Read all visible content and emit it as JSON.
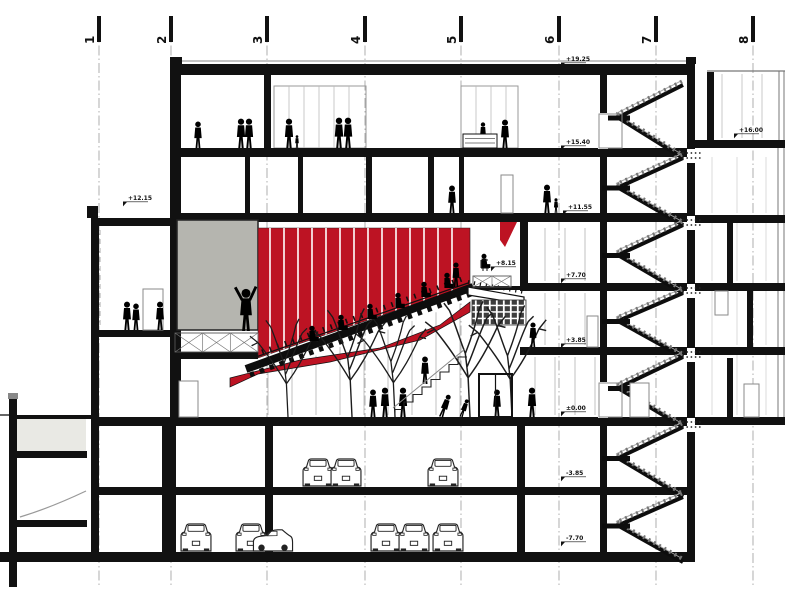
{
  "colors": {
    "red": "#bd1323",
    "gray_box": "#b5b5af",
    "ink": "#111111",
    "silhouette": "#000000",
    "muted": "#999999",
    "light_fill": "#e9e9e4",
    "checker_dark": "#3d3d3d"
  },
  "grid": {
    "axes": [
      {
        "label": "1",
        "x": 99
      },
      {
        "label": "2",
        "x": 171
      },
      {
        "label": "3",
        "x": 267
      },
      {
        "label": "4",
        "x": 365
      },
      {
        "label": "5",
        "x": 461
      },
      {
        "label": "6",
        "x": 559
      },
      {
        "label": "7",
        "x": 656
      },
      {
        "label": "8",
        "x": 753
      }
    ]
  },
  "elevations": [
    {
      "label": "+19.25",
      "x": 565,
      "y": 61
    },
    {
      "label": "+16.00",
      "x": 738,
      "y": 132
    },
    {
      "label": "+15.40",
      "x": 565,
      "y": 144
    },
    {
      "label": "+12.15",
      "x": 127,
      "y": 200
    },
    {
      "label": "+11.55",
      "x": 567,
      "y": 209
    },
    {
      "label": "+8.15",
      "x": 495,
      "y": 265
    },
    {
      "label": "+7.70",
      "x": 565,
      "y": 277
    },
    {
      "label": "+3.85",
      "x": 565,
      "y": 342
    },
    {
      "label": "±0.00",
      "x": 565,
      "y": 410
    },
    {
      "label": "-3.85",
      "x": 565,
      "y": 475
    },
    {
      "label": "-7.70",
      "x": 565,
      "y": 540
    }
  ],
  "auditorium": {
    "fin_start": 270,
    "fin_end": 461,
    "fin_step": 14
  },
  "stairs": {
    "levels": [
      75,
      148,
      215,
      283,
      347,
      417,
      487,
      552
    ],
    "left_x": 616,
    "right_x": 681,
    "landing_x": 602
  },
  "people": [
    {
      "x": 198,
      "y": 148,
      "h": 27,
      "t": "stand"
    },
    {
      "x": 241,
      "y": 148,
      "h": 30,
      "t": "stand"
    },
    {
      "x": 249,
      "y": 148,
      "h": 30,
      "t": "stand"
    },
    {
      "x": 289,
      "y": 148,
      "h": 30,
      "t": "stand"
    },
    {
      "x": 297,
      "y": 148,
      "h": 13,
      "t": "child"
    },
    {
      "x": 339,
      "y": 148,
      "h": 31,
      "t": "stand"
    },
    {
      "x": 348,
      "y": 148,
      "h": 31,
      "t": "stand"
    },
    {
      "x": 483,
      "y": 143,
      "h": 21,
      "t": "stand"
    },
    {
      "x": 505,
      "y": 148,
      "h": 29,
      "t": "stand"
    },
    {
      "x": 452,
      "y": 213,
      "h": 28,
      "t": "stand"
    },
    {
      "x": 547,
      "y": 213,
      "h": 29,
      "t": "stand"
    },
    {
      "x": 556,
      "y": 213,
      "h": 15,
      "t": "child"
    },
    {
      "x": 127,
      "y": 330,
      "h": 29,
      "t": "stand"
    },
    {
      "x": 136,
      "y": 330,
      "h": 27,
      "t": "stand"
    },
    {
      "x": 160,
      "y": 330,
      "h": 29,
      "t": "stand"
    },
    {
      "x": 246,
      "y": 331,
      "h": 43,
      "t": "armup"
    },
    {
      "x": 312,
      "y": 341,
      "h": 15,
      "t": "seated"
    },
    {
      "x": 341,
      "y": 330,
      "h": 15,
      "t": "seated"
    },
    {
      "x": 370,
      "y": 319,
      "h": 15,
      "t": "seated"
    },
    {
      "x": 398,
      "y": 308,
      "h": 15,
      "t": "seated"
    },
    {
      "x": 424,
      "y": 297,
      "h": 15,
      "t": "seated"
    },
    {
      "x": 447,
      "y": 288,
      "h": 15,
      "t": "seated"
    },
    {
      "x": 456,
      "y": 287,
      "h": 25,
      "t": "stand"
    },
    {
      "x": 484,
      "y": 268,
      "h": 14,
      "t": "seated"
    },
    {
      "x": 373,
      "y": 417,
      "h": 28,
      "t": "stand"
    },
    {
      "x": 385,
      "y": 417,
      "h": 30,
      "t": "stand"
    },
    {
      "x": 403,
      "y": 417,
      "h": 30,
      "t": "stand"
    },
    {
      "x": 425,
      "y": 384,
      "h": 28,
      "t": "stand"
    },
    {
      "x": 441,
      "y": 417,
      "h": 24,
      "t": "bend"
    },
    {
      "x": 461,
      "y": 417,
      "h": 19,
      "t": "bend"
    },
    {
      "x": 497,
      "y": 417,
      "h": 28,
      "t": "stand"
    },
    {
      "x": 532,
      "y": 417,
      "h": 30,
      "t": "stand"
    },
    {
      "x": 533,
      "y": 347,
      "h": 25,
      "t": "stand"
    }
  ],
  "cars": [
    {
      "x": 318,
      "y": 486,
      "t": "rear"
    },
    {
      "x": 346,
      "y": 486,
      "t": "rear"
    },
    {
      "x": 443,
      "y": 486,
      "t": "rear"
    },
    {
      "x": 196,
      "y": 551,
      "t": "rear"
    },
    {
      "x": 251,
      "y": 551,
      "t": "rear"
    },
    {
      "x": 273,
      "y": 551,
      "t": "side"
    },
    {
      "x": 386,
      "y": 551,
      "t": "rear"
    },
    {
      "x": 414,
      "y": 551,
      "t": "rear"
    },
    {
      "x": 448,
      "y": 551,
      "t": "rear"
    }
  ],
  "trees": [
    {
      "x": 288,
      "y": 417,
      "h": 95
    },
    {
      "x": 352,
      "y": 417,
      "h": 105
    },
    {
      "x": 395,
      "y": 417,
      "h": 98
    },
    {
      "x": 470,
      "y": 417,
      "h": 112
    },
    {
      "x": 512,
      "y": 417,
      "h": 108
    }
  ]
}
